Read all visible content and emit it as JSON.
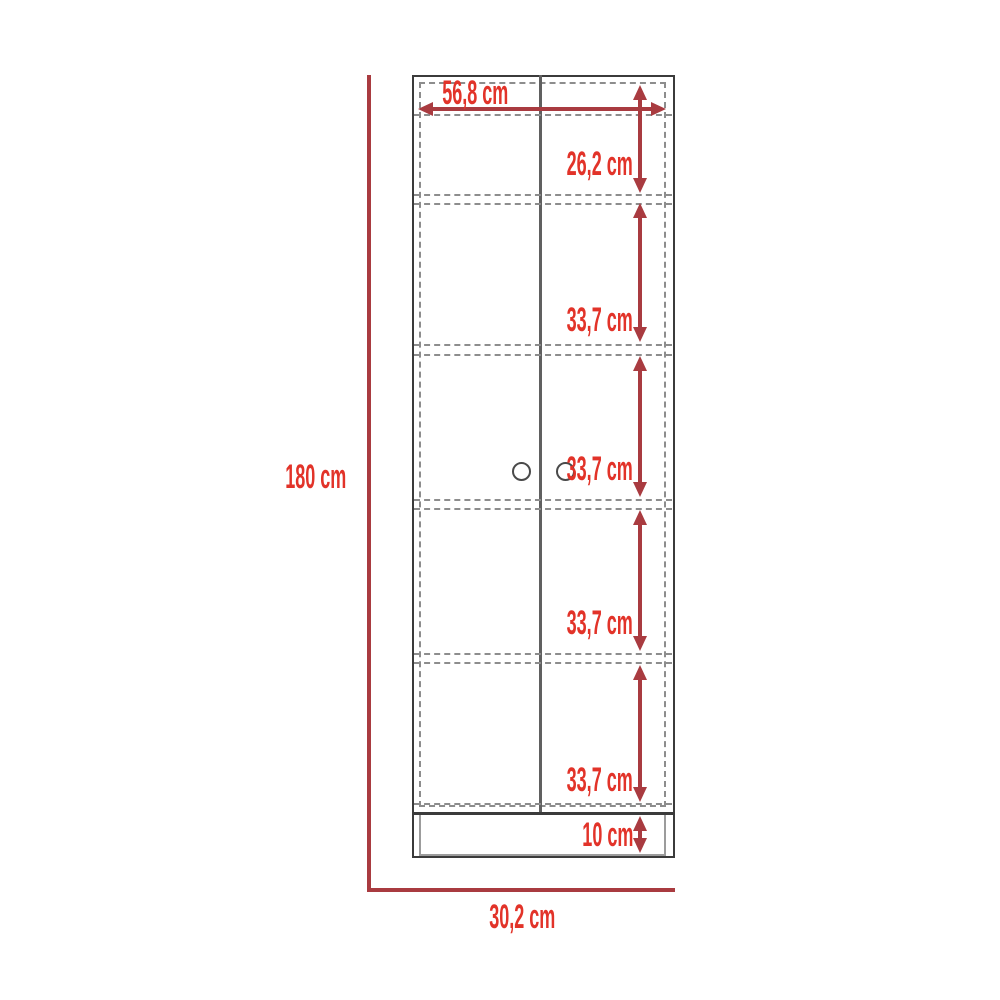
{
  "diagram": {
    "unit": "cm",
    "colors": {
      "label_red": "#e23329",
      "line_red": "#a93b40",
      "outline_gray": "#3b3b3b",
      "dashed_gray": "#8d8d8d"
    }
  },
  "labels": {
    "inner_width": "56,8 cm",
    "top_section_height": "26,2 cm",
    "section_1_height": "33,7 cm",
    "section_2_height": "33,7 cm",
    "section_3_height": "33,7 cm",
    "section_4_height": "33,7 cm",
    "base_height": "10 cm",
    "total_height": "180 cm",
    "total_depth": "30,2 cm"
  }
}
